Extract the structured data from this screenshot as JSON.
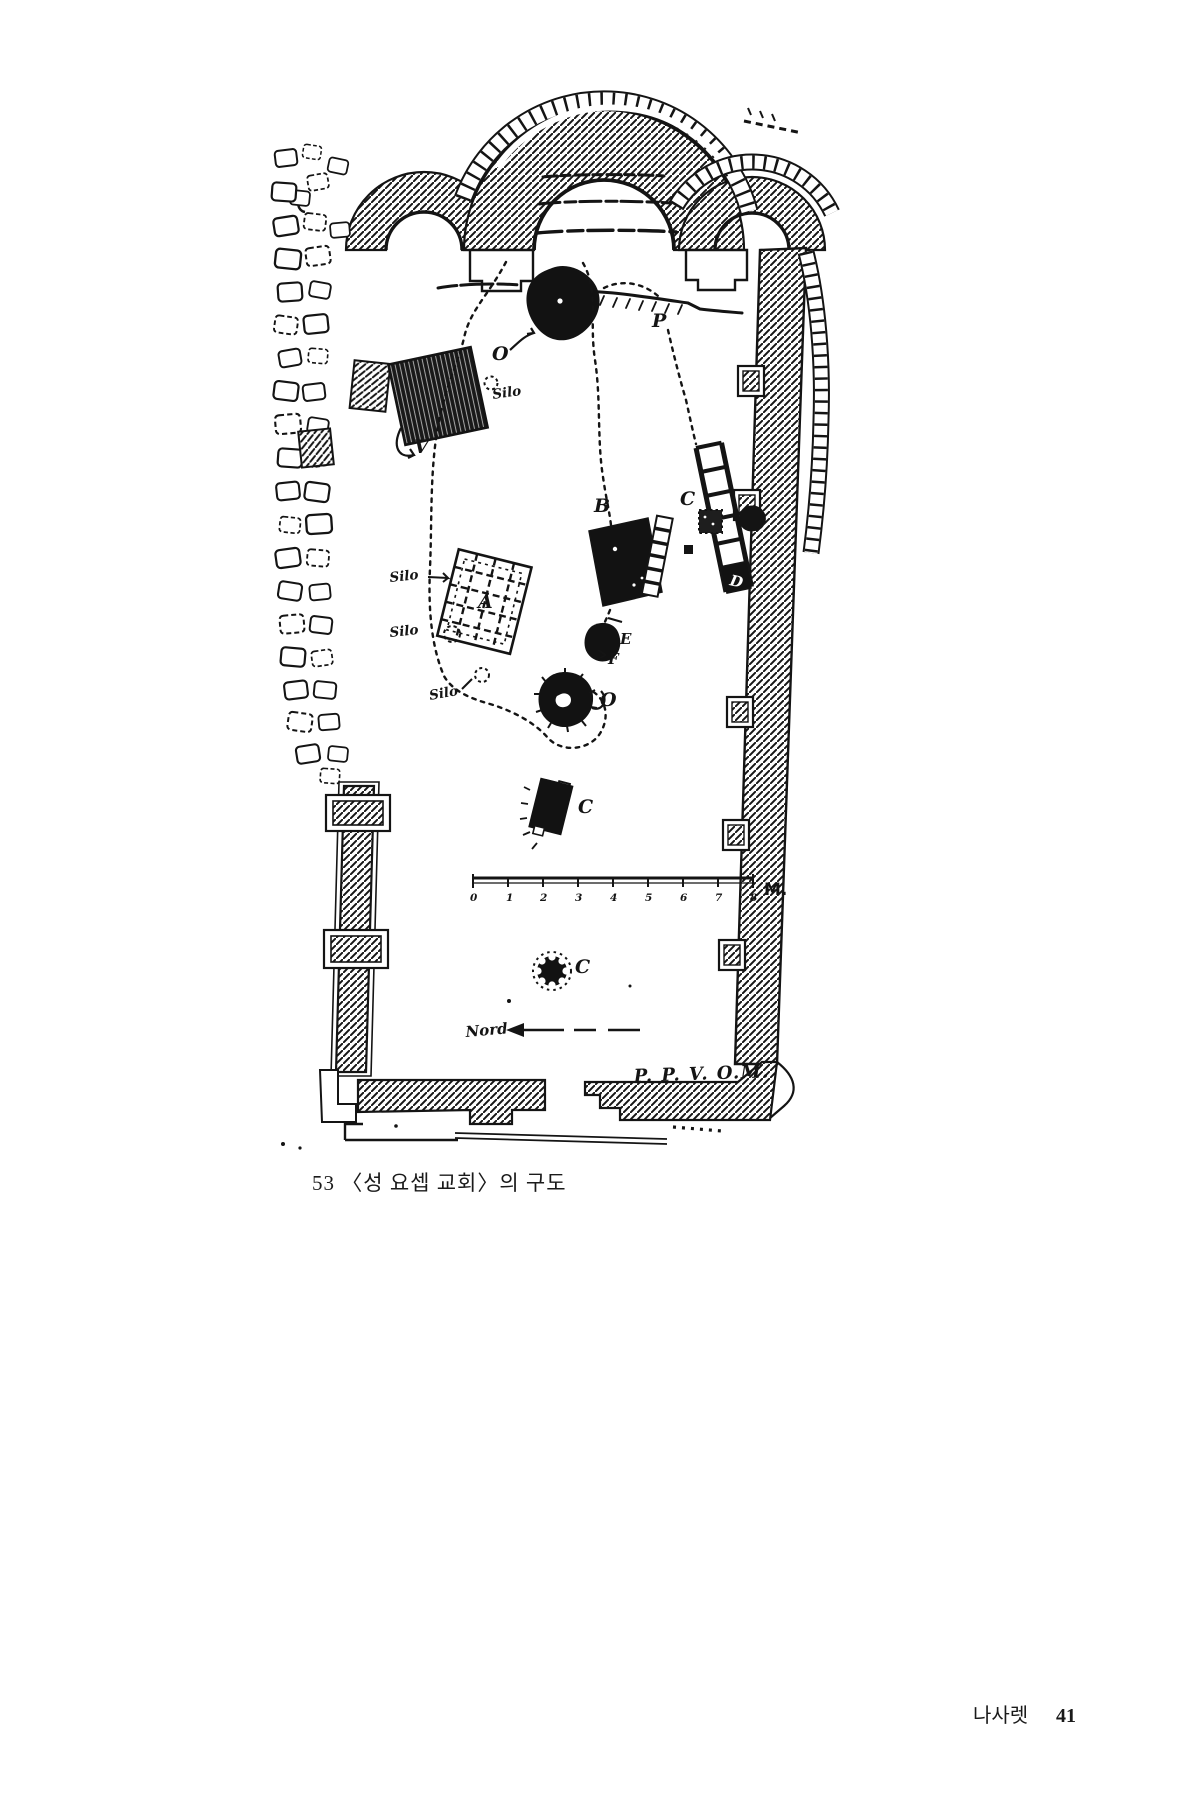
{
  "page": {
    "figure_caption": "53 〈성 요셉 교회〉의 구도",
    "footer": {
      "running_title": "나사렛",
      "page_number": "41"
    }
  },
  "plan": {
    "labels": {
      "v": "V",
      "silo1": "Silo",
      "silo2": "Silo",
      "silo3": "Silo",
      "silo4": "Silo",
      "a": "A",
      "b": "B",
      "d": "D",
      "e": "E",
      "f": "F",
      "p": "P",
      "o_top": "O",
      "o_cistern": "O",
      "c_right": "C",
      "c_middle": "C",
      "c_lower": "C"
    },
    "scale_bar": {
      "tick_labels": [
        "0",
        "1",
        "2",
        "3",
        "4",
        "5",
        "6",
        "7",
        "8"
      ],
      "unit_label": "M."
    },
    "north_arrow": {
      "label": "Nord",
      "direction": "left"
    },
    "surveyor_signature": "P. P. V. O.M.",
    "colors": {
      "ink": "#141414",
      "paper": "#ffffff"
    }
  }
}
